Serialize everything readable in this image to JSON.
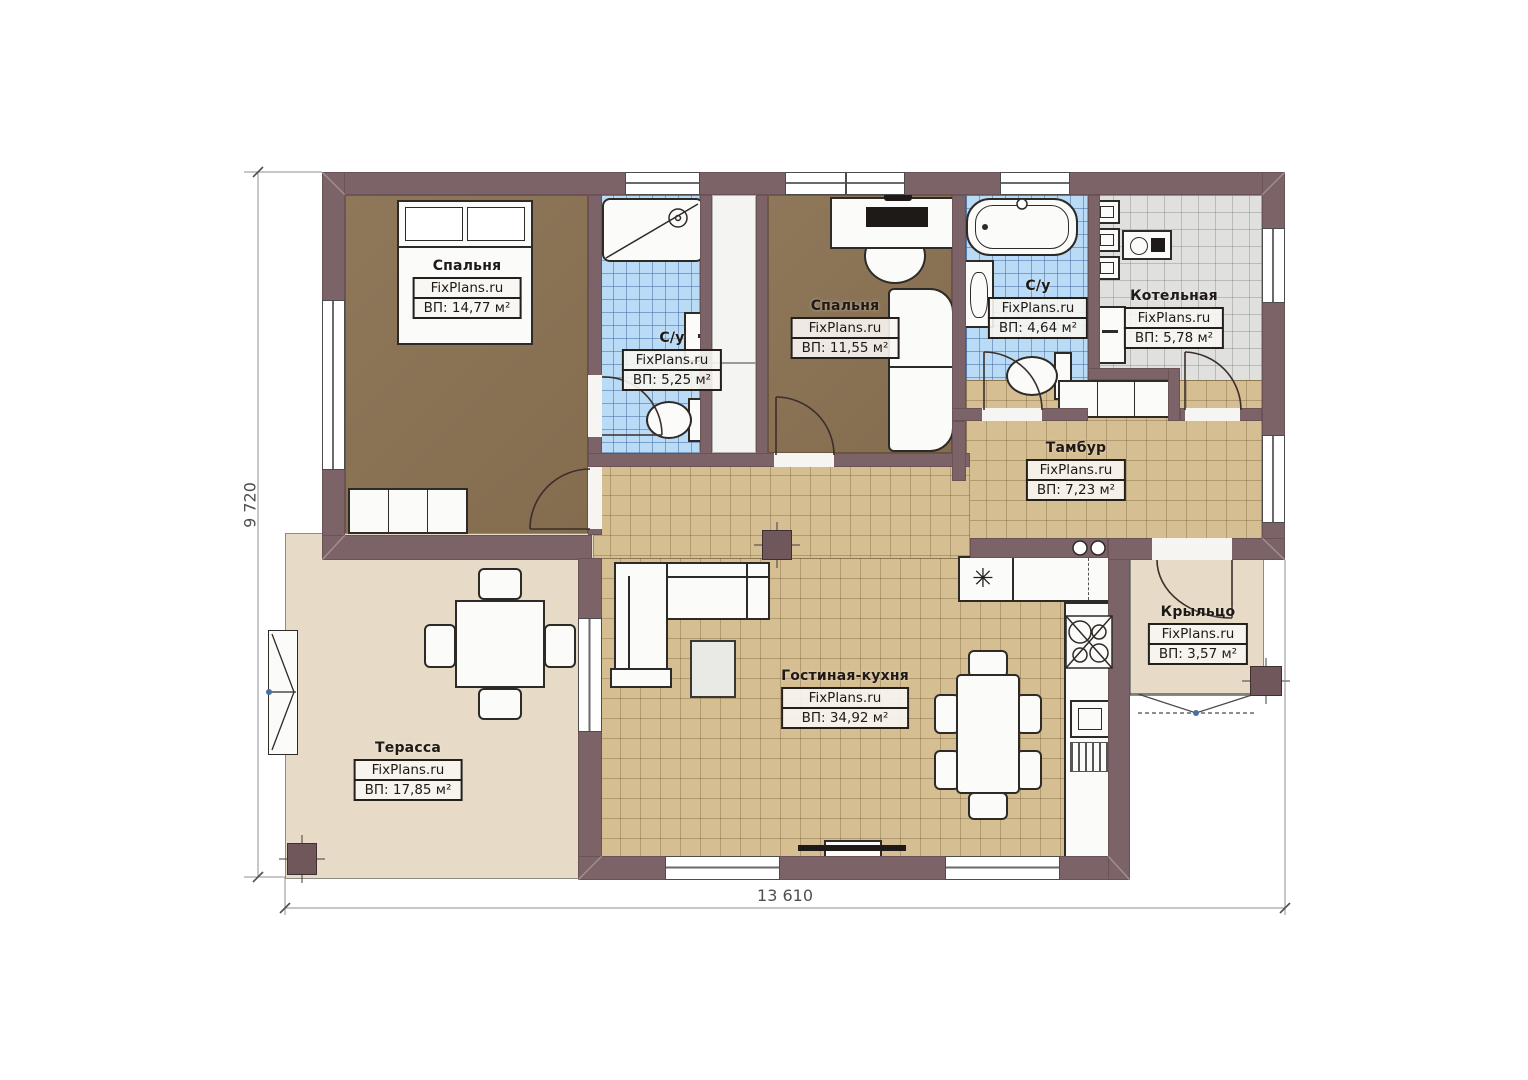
{
  "brand": "FixPlans.ru",
  "rooms": [
    {
      "key": "bedroom-1",
      "name": "Спальня",
      "brand": "FixPlans.ru",
      "area": "ВП: 14,77 м²"
    },
    {
      "key": "bathroom-1",
      "name": "С/у",
      "brand": "FixPlans.ru",
      "area": "ВП: 5,25 м²"
    },
    {
      "key": "bedroom-2",
      "name": "Спальня",
      "brand": "FixPlans.ru",
      "area": "ВП: 11,55 м²"
    },
    {
      "key": "bathroom-2",
      "name": "С/у",
      "brand": "FixPlans.ru",
      "area": "ВП: 4,64 м²"
    },
    {
      "key": "boiler-room",
      "name": "Котельная",
      "brand": "FixPlans.ru",
      "area": "ВП: 5,78 м²"
    },
    {
      "key": "vestibule",
      "name": "Тамбур",
      "brand": "FixPlans.ru",
      "area": "ВП: 7,23 м²"
    },
    {
      "key": "porch",
      "name": "Крыльцо",
      "brand": "FixPlans.ru",
      "area": "ВП: 3,57 м²"
    },
    {
      "key": "living-kitchen",
      "name": "Гостиная-кухня",
      "brand": "FixPlans.ru",
      "area": "ВП: 34,92 м²"
    },
    {
      "key": "terrace",
      "name": "Терасса",
      "brand": "FixPlans.ru",
      "area": "ВП: 17,85 м²"
    }
  ],
  "dimensions": {
    "width_label": "13 610",
    "height_label": "9 720"
  },
  "icons": {
    "fridge_snowflake": "✳"
  },
  "colors": {
    "wall": "#7c6367",
    "bedroom_floor": "#8a7254",
    "wet_tile": "#badbf5",
    "beige_tile": "#d6be93",
    "boiler_tile": "#e0e0de",
    "terrace_floor": "#e7dbc7",
    "dimension_text": "#4f4f4f"
  }
}
